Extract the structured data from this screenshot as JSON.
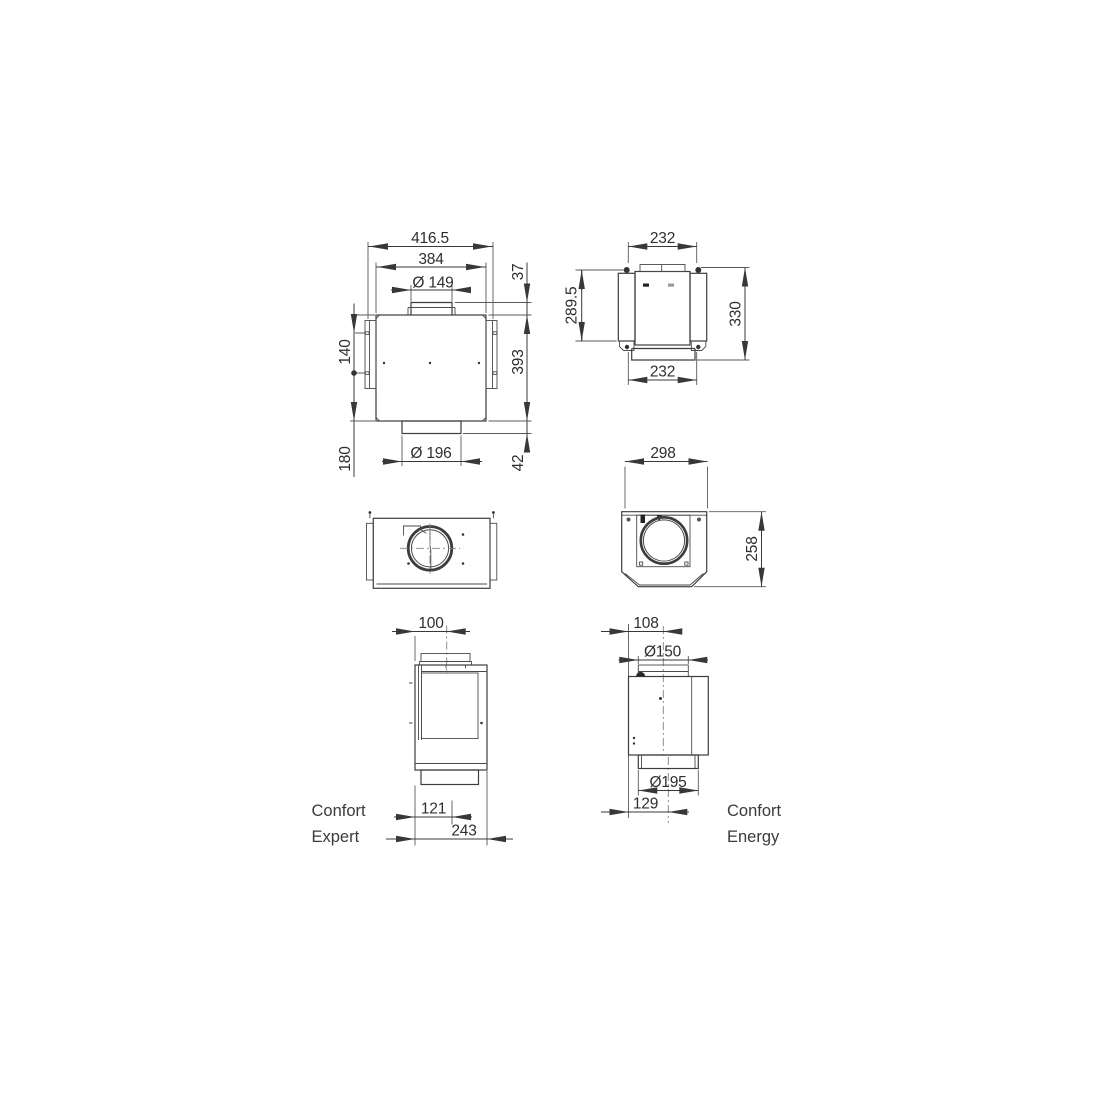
{
  "colors": {
    "background": "#ffffff",
    "line": "#3d3d3d",
    "text": "#2e2e2e"
  },
  "views": {
    "front": {
      "dims": {
        "overall_width": "416.5",
        "body_width": "384",
        "top_duct_diameter": "Ø 149",
        "duct_protrusion": "37",
        "bracket_hole_spacing": "140",
        "body_height": "393",
        "hole_to_bottom": "180",
        "bottom_collar_diameter": "Ø 196",
        "collar_height": "42"
      }
    },
    "side": {
      "dims": {
        "top_width": "232",
        "flange_height": "289.5",
        "overall_height": "330",
        "bottom_width": "232"
      }
    },
    "rear": {
      "dims": {
        "width": "298",
        "height": "258"
      }
    },
    "expert": {
      "label_line1": "Confort",
      "label_line2": "Expert",
      "dims": {
        "rear_to_duct_axis": "100",
        "rear_to_front_panel": "121",
        "overall_depth": "243"
      }
    },
    "energy": {
      "label_line1": "Confort",
      "label_line2": "Energy",
      "dims": {
        "rear_to_duct_axis": "108",
        "duct_diameter": "Ø150",
        "collar_diameter": "Ø195",
        "rear_to_collar_axis": "129"
      }
    }
  }
}
